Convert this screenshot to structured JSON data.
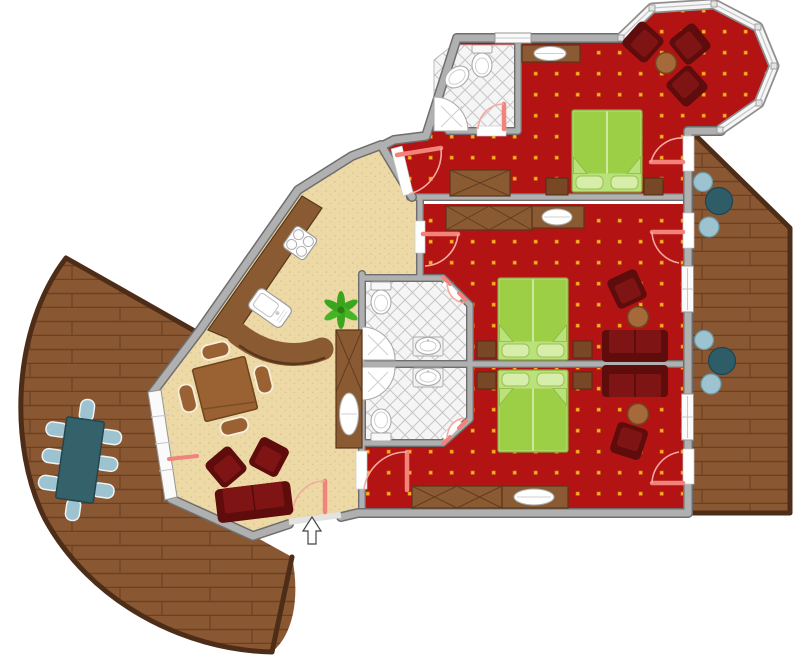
{
  "meta": {
    "kind": "apartment-floor-plan",
    "canvas": {
      "width": 800,
      "height": 659
    },
    "visible_text": "none"
  },
  "colors": {
    "bg": "#ffffff",
    "wall": "#b0b0b0",
    "wall_edge": "#6e6e6e",
    "carpet": "#b31313",
    "carpet_dot": "#ffb020",
    "carpet_dot_edge": "#c8780e",
    "floor": "#ecd9a6",
    "floor_dot": "#d6bd85",
    "tile": "#f5f5f5",
    "tile_line": "#c6c6c6",
    "wood": "#8a5733",
    "wood_line": "#6b4123",
    "wood_edge": "#4e2d18",
    "furn_dark": "#5e0c0c",
    "furn_mid": "#7f1414",
    "bed_light": "#b9e27a",
    "bed_mid": "#9ccf45",
    "bed_pillow": "#d7edaa",
    "brown": "#8a5a33",
    "brown_edge": "#59361c",
    "table_round": "#a5693a",
    "teal_dark": "#2e5d68",
    "teal_light": "#9cc3cf",
    "teal_table": "#35616b",
    "plant": "#3aa51d",
    "door_pink": "#f2837b",
    "arc_pink": "#f5a9a1",
    "fixture": "#ffffff",
    "fixture_line": "#ababab",
    "window_fill": "#fafafa",
    "window_line": "#969696"
  },
  "rooms": [
    {
      "id": "bedroom-top",
      "floor": "red-carpet-dotted",
      "furniture": [
        "double-bed",
        "wardrobe",
        "nightstand-left",
        "nightstand-right",
        "vanity-with-basin",
        "door-to-hall",
        "door-to-balcony"
      ]
    },
    {
      "id": "bay-window-lounge",
      "floor": "red-carpet-dotted",
      "furniture": [
        "armchair",
        "armchair",
        "armchair",
        "round-side-table"
      ],
      "windows": 6
    },
    {
      "id": "bedroom-middle",
      "floor": "red-carpet-dotted",
      "furniture": [
        "double-bed",
        "wardrobe",
        "vanity-with-basin",
        "nightstand-left",
        "nightstand-right",
        "sofa",
        "armchair",
        "round-side-table",
        "door-to-hall",
        "door-to-balcony",
        "window"
      ]
    },
    {
      "id": "bedroom-bottom",
      "floor": "red-carpet-dotted",
      "furniture": [
        "double-bed",
        "nightstand-left",
        "nightstand-right",
        "sofa",
        "armchair",
        "round-side-table",
        "wardrobe",
        "tv-sideboard",
        "door-to-living",
        "door-to-balcony",
        "window"
      ]
    },
    {
      "id": "bathroom-top",
      "floor": "diamond-tile",
      "fixtures": [
        "toilet",
        "washbasin",
        "corner-shower"
      ]
    },
    {
      "id": "bathroom-middle",
      "floor": "diamond-tile",
      "fixtures": [
        "toilet",
        "washbasin",
        "corner-shower"
      ]
    },
    {
      "id": "bathroom-bottom",
      "floor": "diamond-tile",
      "fixtures": [
        "toilet",
        "washbasin",
        "corner-shower"
      ]
    },
    {
      "id": "living-dining-kitchen",
      "floor": "beige-textured",
      "furniture": [
        "kitchen-counter",
        "stove-4-burner",
        "kitchen-sink",
        "curved-bar-counter",
        "dining-table",
        "dining-chairs-x4",
        "potted-plant",
        "tv-sideboard-with-basin-oval",
        "armchair",
        "armchair",
        "sofa",
        "entry-door",
        "window-wall-to-terrace"
      ]
    },
    {
      "id": "terrace-left",
      "floor": "wood-deck-curved",
      "furniture": [
        "outdoor-table",
        "outdoor-chairs-x8"
      ]
    },
    {
      "id": "balcony-right",
      "floor": "wood-deck",
      "furniture": [
        "round-table-group",
        "round-table-group"
      ]
    }
  ],
  "annotations": {
    "entry_arrow_direction": "up",
    "door_swing_marks": "pink"
  }
}
